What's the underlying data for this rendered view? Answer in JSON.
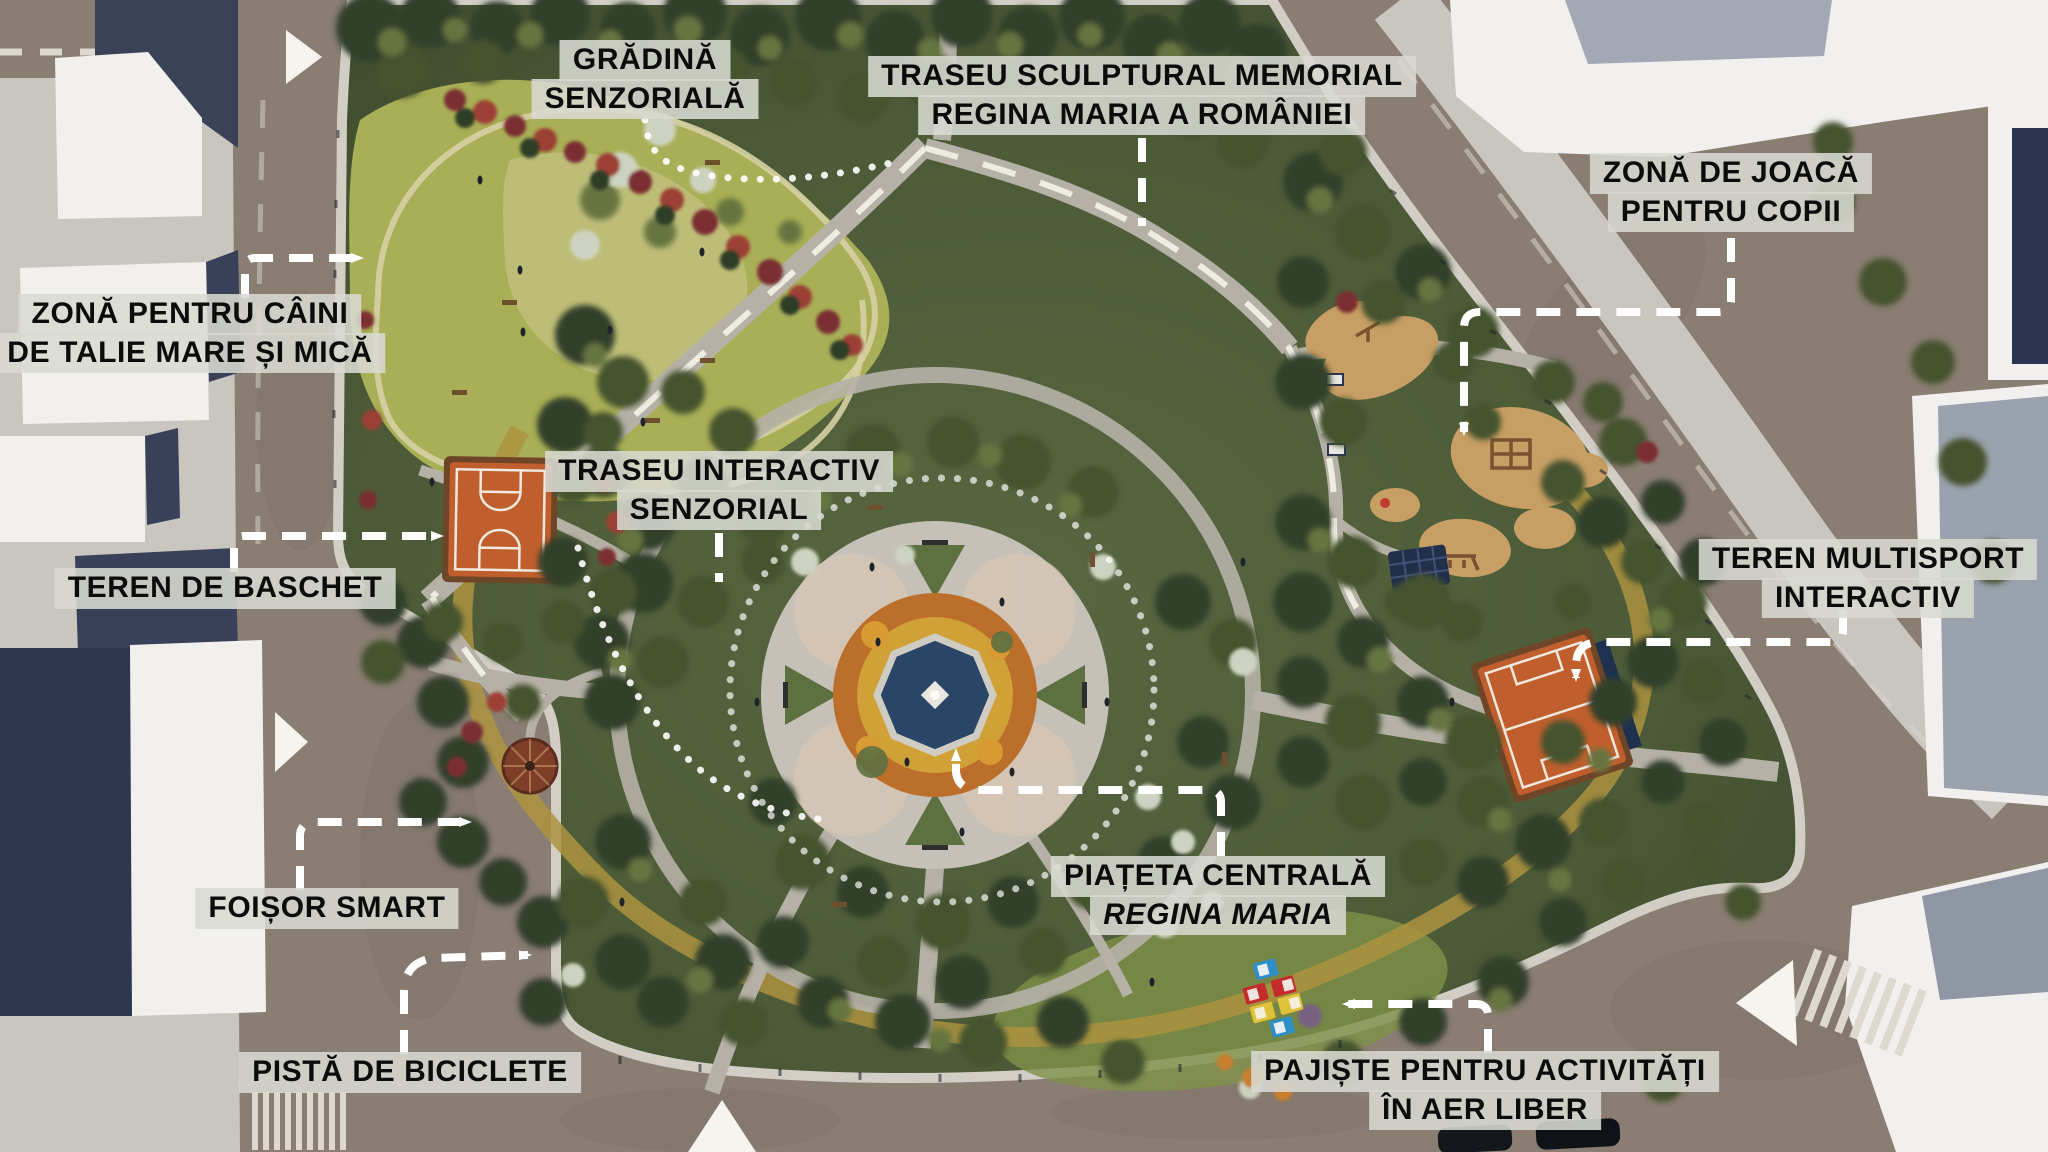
{
  "labels": {
    "gradina_senzoriala": {
      "lines": [
        "GRĂDINĂ",
        "SENZORIALĂ"
      ]
    },
    "traseu_sculptural": {
      "lines": [
        "TRASEU SCULPTURAL MEMORIAL",
        "REGINA MARIA A ROMÂNIEI"
      ]
    },
    "zona_joaca": {
      "lines": [
        "ZONĂ DE JOACĂ",
        "PENTRU COPII"
      ]
    },
    "zona_caini": {
      "lines": [
        "ZONĂ PENTRU CÂINI",
        "DE TALIE MARE ȘI MICĂ"
      ]
    },
    "traseu_interactiv": {
      "lines": [
        "TRASEU INTERACTIV",
        "SENZORIAL"
      ]
    },
    "teren_baschet": {
      "lines": [
        "TEREN DE BASCHET"
      ]
    },
    "teren_multisport": {
      "lines": [
        "TEREN MULTISPORT",
        "INTERACTIV"
      ]
    },
    "foisor_smart": {
      "lines": [
        "FOIȘOR SMART"
      ]
    },
    "piateta_centrala": {
      "lines": [
        "PIAȚETA CENTRALĂ",
        "REGINA MARIA"
      ]
    },
    "pista_biciclete": {
      "lines": [
        "PISTĂ DE BICICLETE"
      ]
    },
    "pajiste": {
      "lines": [
        "PAJIȘTE PENTRU ACTIVITĂȚI",
        "ÎN AER LIBER"
      ]
    }
  },
  "colors": {
    "label_bg": "#d8dad1",
    "label_text": "#0c0c0c",
    "arrow": "#ffffff",
    "court_orange": "#c05f2d",
    "pool_blue": "#2a4565",
    "flower_ring": "#bc6f2b",
    "dog_lawn": "#a9af56",
    "canopy": "#4c5a37",
    "road": "#8a7d72",
    "building": "#f1f0ed",
    "bike_path": "#ad933f"
  }
}
